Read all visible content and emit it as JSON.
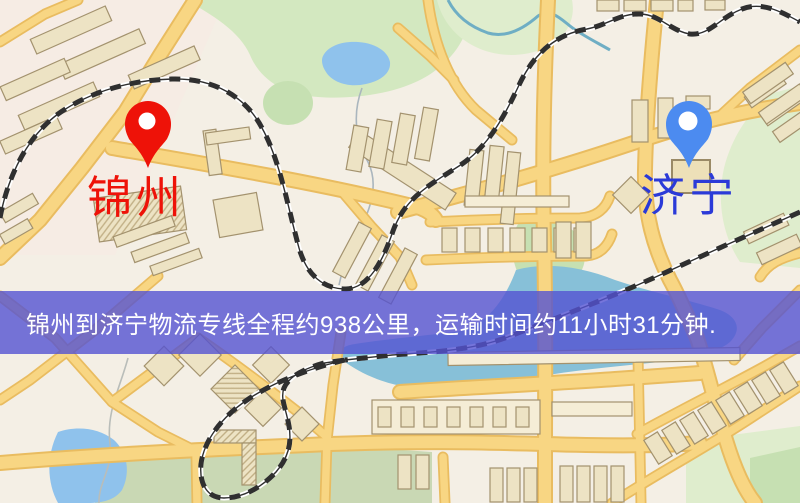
{
  "banner": {
    "text": "锦州到济宁物流专线全程约938公里，运输时间约11小时31分钟.",
    "background": "rgba(84,82,210,0.8)",
    "text_color": "#FFFFFF"
  },
  "markers": {
    "origin": {
      "label": "锦州",
      "label_color": "#EE1208",
      "pin_color": "#EE1208"
    },
    "destination": {
      "label": "济宁",
      "label_color": "#2B3AD8",
      "pin_color": "#4C8BF0"
    }
  },
  "map": {
    "type": "street-map",
    "colors": {
      "background": "#F4EFE5",
      "park": "#D3E8C0",
      "water": "#8FC2EC",
      "road_fill": "#F8D683",
      "road_casing": "#E9BC60",
      "building": "#EDE3C4",
      "building_border": "#A3926E",
      "railway": "#2F2F2F"
    }
  }
}
